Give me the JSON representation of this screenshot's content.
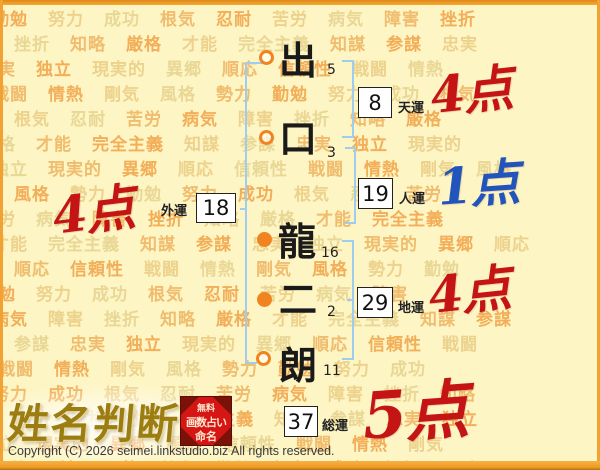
{
  "name_chart": {
    "characters": [
      {
        "char": "出",
        "strokes": "5",
        "marker": "open"
      },
      {
        "char": "口",
        "strokes": "3",
        "marker": "open"
      },
      {
        "char": "龍",
        "strokes": "16",
        "marker": "filled"
      },
      {
        "char": "二",
        "strokes": "2",
        "marker": "filled"
      },
      {
        "char": "朗",
        "strokes": "11",
        "marker": "open"
      }
    ],
    "fortunes": {
      "tenun": {
        "label": "天運",
        "value": "8",
        "score": "4点",
        "color": "#c41414"
      },
      "jinun": {
        "label": "人運",
        "value": "19",
        "score": "1点",
        "color": "#2255bb"
      },
      "chiun": {
        "label": "地運",
        "value": "29",
        "score": "4点",
        "color": "#c41414"
      },
      "gaiun": {
        "label": "外運",
        "value": "18",
        "score": "4点",
        "color": "#c41414"
      },
      "souun": {
        "label": "総運",
        "value": "37",
        "score": "5点",
        "color": "#c41414"
      }
    }
  },
  "background": {
    "words": [
      "勤勉",
      "努力",
      "成功",
      "根気",
      "忍耐",
      "苦労",
      "病気",
      "障害",
      "挫折",
      "知略",
      "厳格",
      "才能",
      "完全主義",
      "知謀",
      "参謀",
      "忠実",
      "独立",
      "現実的",
      "異郷",
      "順応",
      "信頼性",
      "戦闘",
      "情熱",
      "剛気",
      "風格",
      "勢力"
    ],
    "palette": [
      "#f2ae58",
      "#edd28d",
      "#e9d795",
      "#f0bc6e"
    ]
  },
  "logo": {
    "title": "姓名判断",
    "seal_lines": [
      "無料",
      "画数占い",
      "命名"
    ]
  },
  "footer": {
    "copyright": "Copyright (C) 2026 seimei.linkstudio.biz All rights reserved."
  },
  "colors": {
    "page_background": "#fdf5c4",
    "frame_orange": "#f2a233",
    "bracket_blue": "#9ecdf0",
    "marker_orange": "#ef8420",
    "score_red": "#c41414",
    "score_blue": "#2255bb",
    "seal_red": "#d61515",
    "logo_gold": "#9c7d10"
  }
}
